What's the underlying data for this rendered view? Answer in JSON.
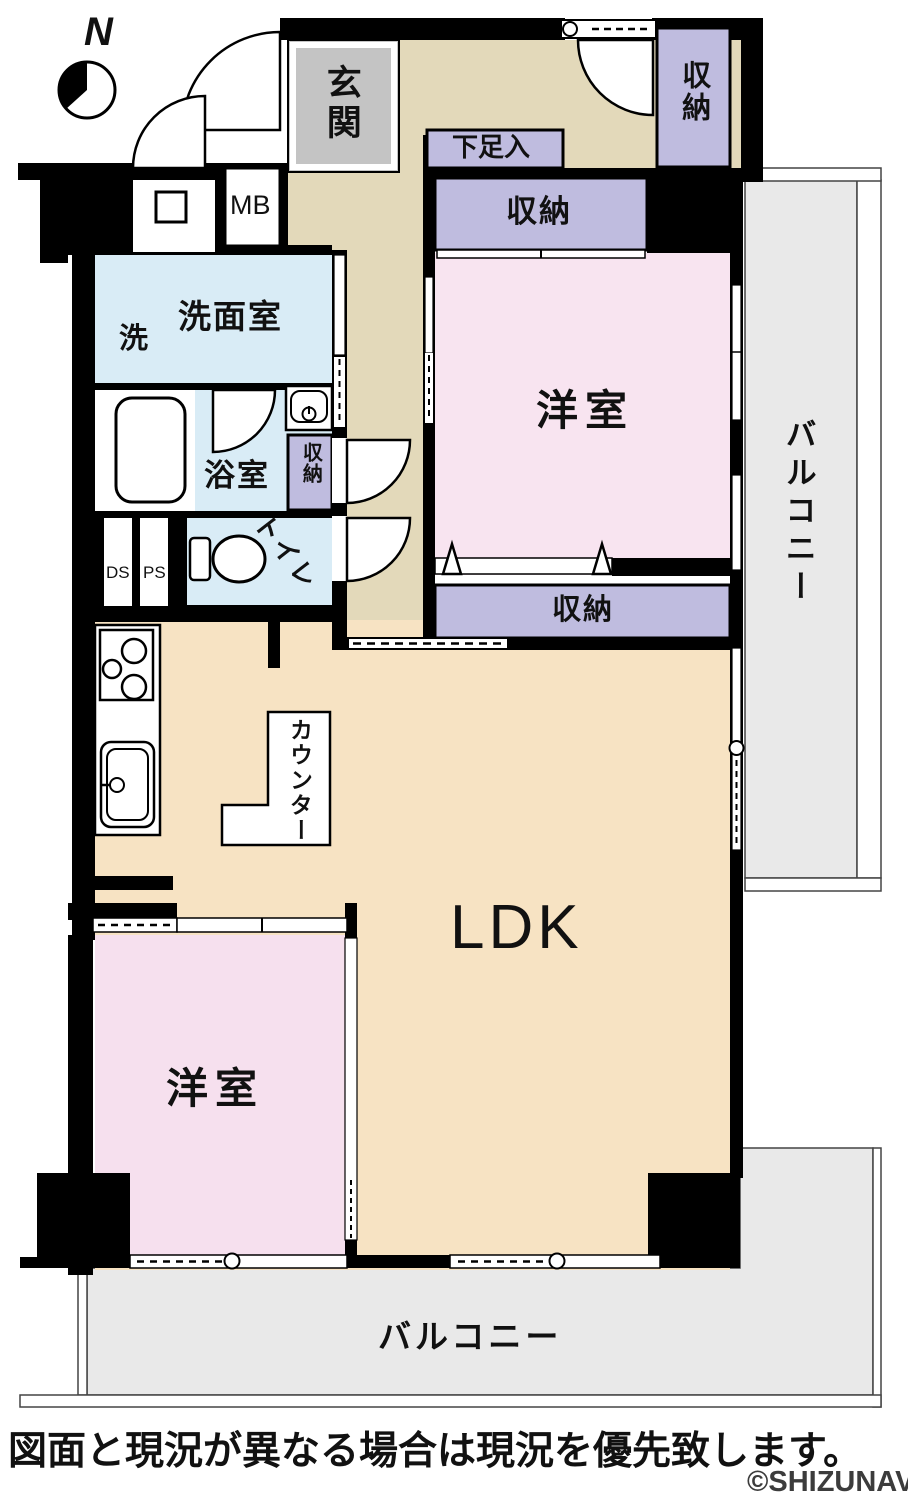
{
  "compass": {
    "north_label": "N"
  },
  "rooms": {
    "genkan": "玄関",
    "mb": "MB",
    "shoe_cabinet": "下足入",
    "closet": "収納",
    "bedroom1": "洋室",
    "bedroom2": "洋室",
    "balcony_right": "バルコニー",
    "balcony_bottom": "バルコニー",
    "washer": "洗",
    "washroom": "洗面室",
    "bathroom": "浴室",
    "toilet": "トイレ",
    "ds": "DS",
    "ps": "PS",
    "counter": "カウンター",
    "ldk": "LDK"
  },
  "footer": {
    "disclaimer": "図面と現況が異なる場合は現況を優先致します。",
    "watermark": "©SHIZUNAVI"
  },
  "colors": {
    "wall": "#000000",
    "hall_tan": "#e3d9ba",
    "ldk_tan": "#f7e3c3",
    "bedroom_pink": "#f8e4f0",
    "closet_lavender": "#bfbcdf",
    "wet_blue": "#d9ecf6",
    "genkan_gray": "#c4c4c4",
    "balcony_gray": "#e9e9e9"
  }
}
